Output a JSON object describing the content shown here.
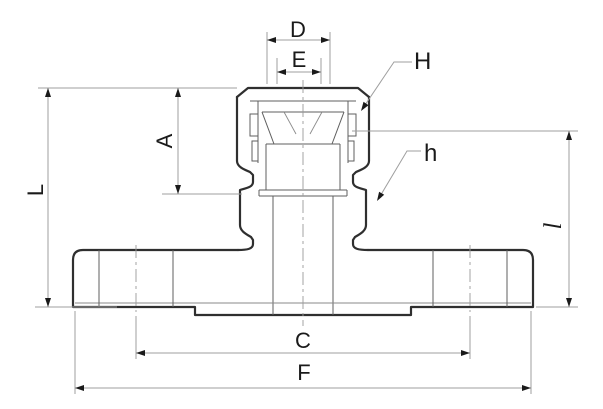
{
  "figure": {
    "description": "Engineering cross-section drawing of a flanged union fitting with dimension callouts",
    "colors": {
      "background": "#ffffff",
      "outline": "#2f2f2f",
      "thin_line": "#5f5f5f",
      "dimension_line": "#9f9f9f",
      "label_text": "#1a1a1a"
    }
  },
  "dims": {
    "D": "D",
    "E": "E",
    "H": "H",
    "A": "A",
    "L": "L",
    "h": "h",
    "C": "C",
    "F": "F",
    "l": "l"
  }
}
